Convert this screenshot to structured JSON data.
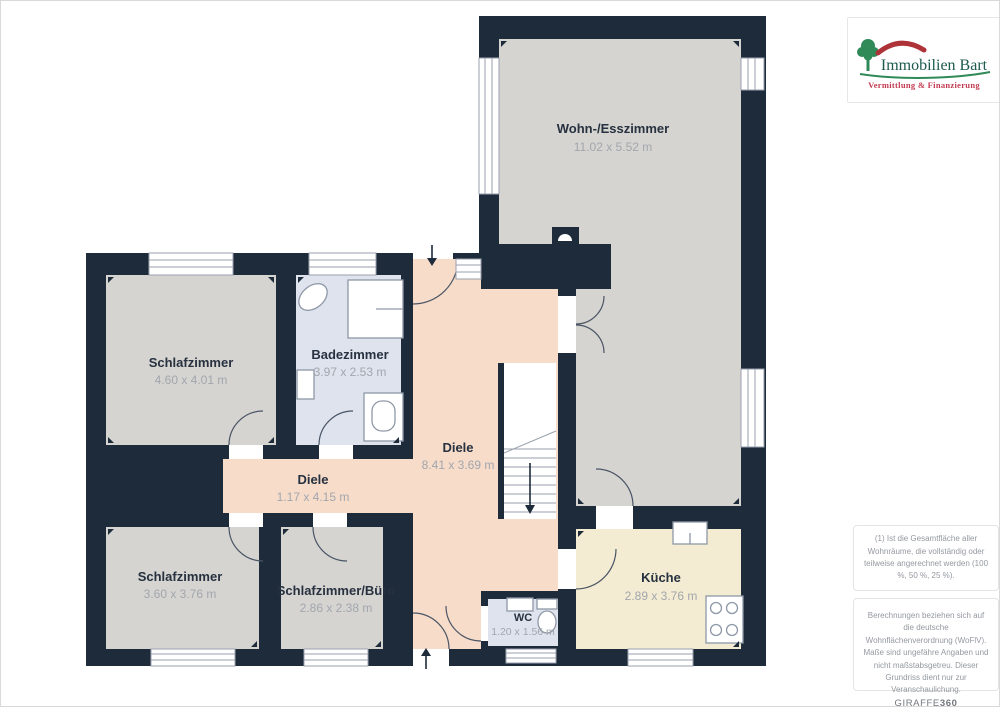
{
  "branding": {
    "company": "Immobilien Bart",
    "tagline": "Vermittlung & Finanzierung"
  },
  "floorplan": {
    "rooms": [
      {
        "id": "wohn_esszimmer",
        "label": "Wohn-/Esszimmer",
        "dims": "11.02 x 5.52 m"
      },
      {
        "id": "schlafzimmer_1",
        "label": "Schlafzimmer",
        "dims": "4.60 x 4.01 m"
      },
      {
        "id": "badezimmer",
        "label": "Badezimmer",
        "dims": "3.97 x 2.53 m"
      },
      {
        "id": "diele_haupt",
        "label": "Diele",
        "dims": "8.41 x 3.69 m"
      },
      {
        "id": "diele_flur",
        "label": "Diele",
        "dims": "1.17 x 4.15 m"
      },
      {
        "id": "schlafzimmer_2",
        "label": "Schlafzimmer",
        "dims": "3.60 x 3.76 m"
      },
      {
        "id": "schlafzimmer_buero",
        "label": "Schlafzimmer/Büro",
        "dims": "2.86 x 2.38 m"
      },
      {
        "id": "kueche",
        "label": "Küche",
        "dims": "2.89 x 3.76 m"
      },
      {
        "id": "wc",
        "label": "WC",
        "dims": "1.20 x 1.56 m"
      }
    ],
    "colors": {
      "wall": "#1d2b3a",
      "room_floor": "#d5d4d1",
      "bathroom_floor": "#dee3ee",
      "hallway_floor": "#f7dcca",
      "kitchen_floor": "#f3ecd2"
    }
  },
  "notes": {
    "area_note": "(1) Ist die Gesamtfläche aller Wohnräume, die vollständig oder teilweise angerechnet werden (100 %, 50 %, 25 %).",
    "disclaimer": "Berechnungen beziehen sich auf die deutsche Wohnflächenverordnung (WoFlV). Maße sind ungefähre Angaben und nicht maßstabsgetreu. Dieser Grundriss dient nur zur Veranschaulichung.",
    "watermark": {
      "brand": "GIRAFFE",
      "suffix": "360"
    }
  },
  "logo_colors": {
    "tree_green": "#2f8a58",
    "name_green": "#1b5a4d",
    "roof_red": "#ae3339",
    "tagline_red": "#c43b51"
  }
}
